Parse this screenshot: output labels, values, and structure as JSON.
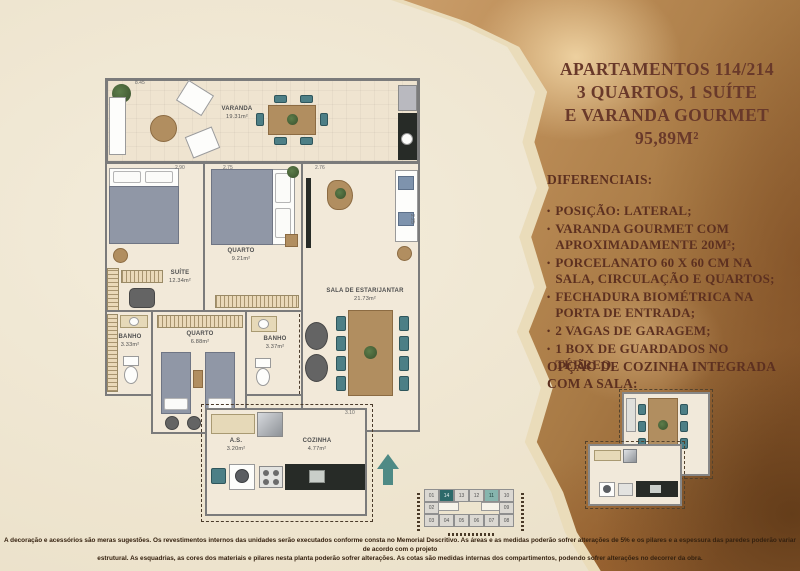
{
  "header": {
    "title_lines": [
      "APARTAMENTOS 114/214",
      "3 QUARTOS, 1 SUÍTE",
      "E VARANDA GOURMET",
      "95,89M²"
    ]
  },
  "diferenciais": {
    "heading": "DIFERENCIAIS:",
    "bullet": "•",
    "items": [
      "POSIÇÃO: LATERAL;",
      "VARANDA GOURMET COM APROXIMADAMENTE 20M²;",
      "PORCELANATO 60 X 60 CM NA SALA, CIRCULAÇÃO E QUARTOS;",
      "FECHADURA BIOMÉTRICA NA PORTA DE ENTRADA;",
      "2 VAGAS DE GARAGEM;",
      "1 BOX DE GUARDADOS NO TÉRREO."
    ]
  },
  "option": {
    "heading_line1": "OPÇÃO DE COZINHA INTEGRADA",
    "heading_line2": "COM A SALA:"
  },
  "plan": {
    "varanda": {
      "name": "VARANDA",
      "area": "19.31m²"
    },
    "suite": {
      "name": "SUÍTE",
      "area": "12.34m²"
    },
    "quarto1": {
      "name": "QUARTO",
      "area": "9.21m²"
    },
    "sala": {
      "name": "SALA DE ESTAR/JANTAR",
      "area": "21.73m²"
    },
    "banho1": {
      "name": "BANHO",
      "area": "3.33m²"
    },
    "quarto2": {
      "name": "QUARTO",
      "area": "6.88m²"
    },
    "banho2": {
      "name": "BANHO",
      "area": "3.37m²"
    },
    "as": {
      "name": "A.S.",
      "area": "3.20m²"
    },
    "cozinha": {
      "name": "COZINHA",
      "area": "4.77m²"
    },
    "dims": {
      "top": "8.45",
      "suite_w": "2.90",
      "quarto_w": "2.75",
      "sala_w": "2.76",
      "varanda_d": "2.25",
      "kitchen_w": "3.10"
    }
  },
  "key_plan": {
    "row_top": [
      "01",
      "14",
      "13",
      "12",
      "11",
      "10"
    ],
    "row_mid_left": "02",
    "row_mid_right": "09",
    "row_bottom": [
      "03",
      "04",
      "05",
      "06",
      "07",
      "08"
    ],
    "highlighted_units": [
      "14",
      "11"
    ]
  },
  "disclaimer": {
    "line1": "A decoração e acessórios são meras sugestões. Os revestimentos internos das unidades serão executados conforme consta no Memorial Descritivo. As áreas e as medidas poderão sofrer alterações de 5% e os pilares e a espessura das paredes poderão variar de acordo com o projeto",
    "line2": "estrutural. As esquadrias, as cores dos materiais e pilares nesta planta poderão sofrer alterações. As cotas são medidas internas dos compartimentos, podendo sofrer alterações no decorrer da obra."
  },
  "colors": {
    "accent_teal": "#2c6a6a",
    "paper_brown": "#bd8e58",
    "text_brown": "#5d3020",
    "dark_counter": "#272b27",
    "wood": "#b18e60"
  }
}
